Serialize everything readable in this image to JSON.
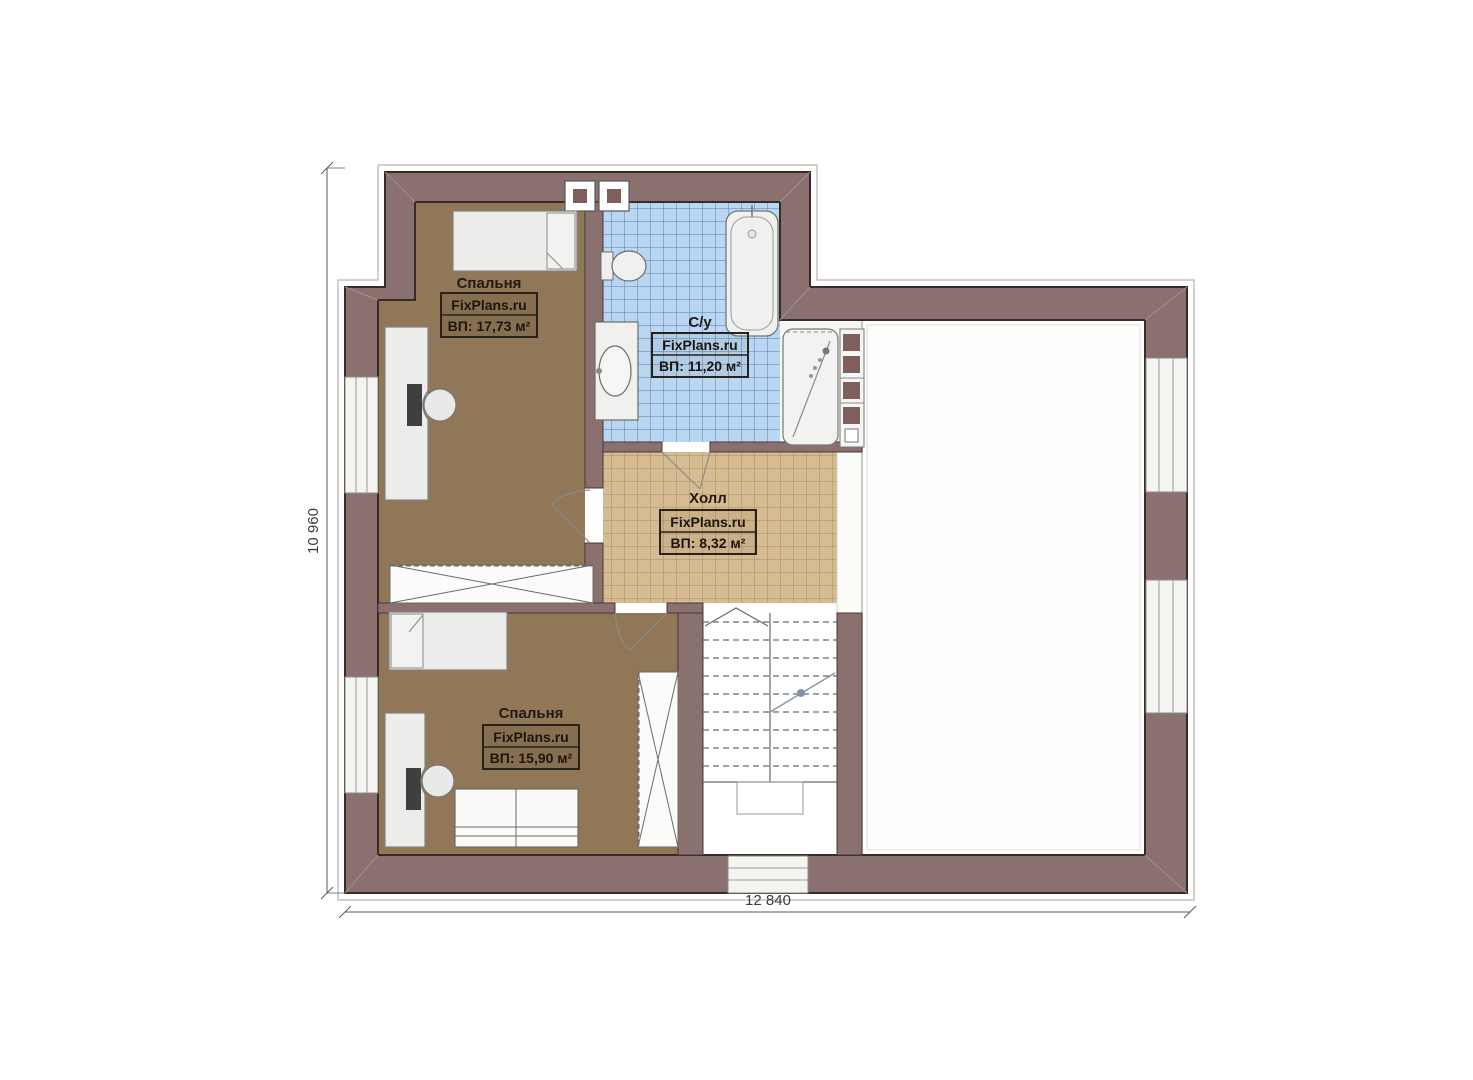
{
  "plan": {
    "rooms": [
      {
        "name": "Спальня",
        "watermark": "FixPlans.ru",
        "area": "ВП: 17,73 м²"
      },
      {
        "name": "С/у",
        "watermark": "FixPlans.ru",
        "area": "ВП: 11,20 м²"
      },
      {
        "name": "Холл",
        "watermark": "FixPlans.ru",
        "area": "ВП: 8,32 м²"
      },
      {
        "name": "Спальня",
        "watermark": "FixPlans.ru",
        "area": "ВП: 15,90 м²"
      }
    ],
    "dimensions": {
      "width": "12 840",
      "height": "10 960"
    },
    "colors": {
      "wall": "#8a7170",
      "wall_edge": "#372b28",
      "bedroom_floor": "#8f7757",
      "bath_tile": "#b9d7f2",
      "bath_tile_line": "#5b7da8",
      "hall_tile": "#d6bc92",
      "hall_tile_line": "#a68c60",
      "accent_square": "#7d5f5c"
    }
  }
}
